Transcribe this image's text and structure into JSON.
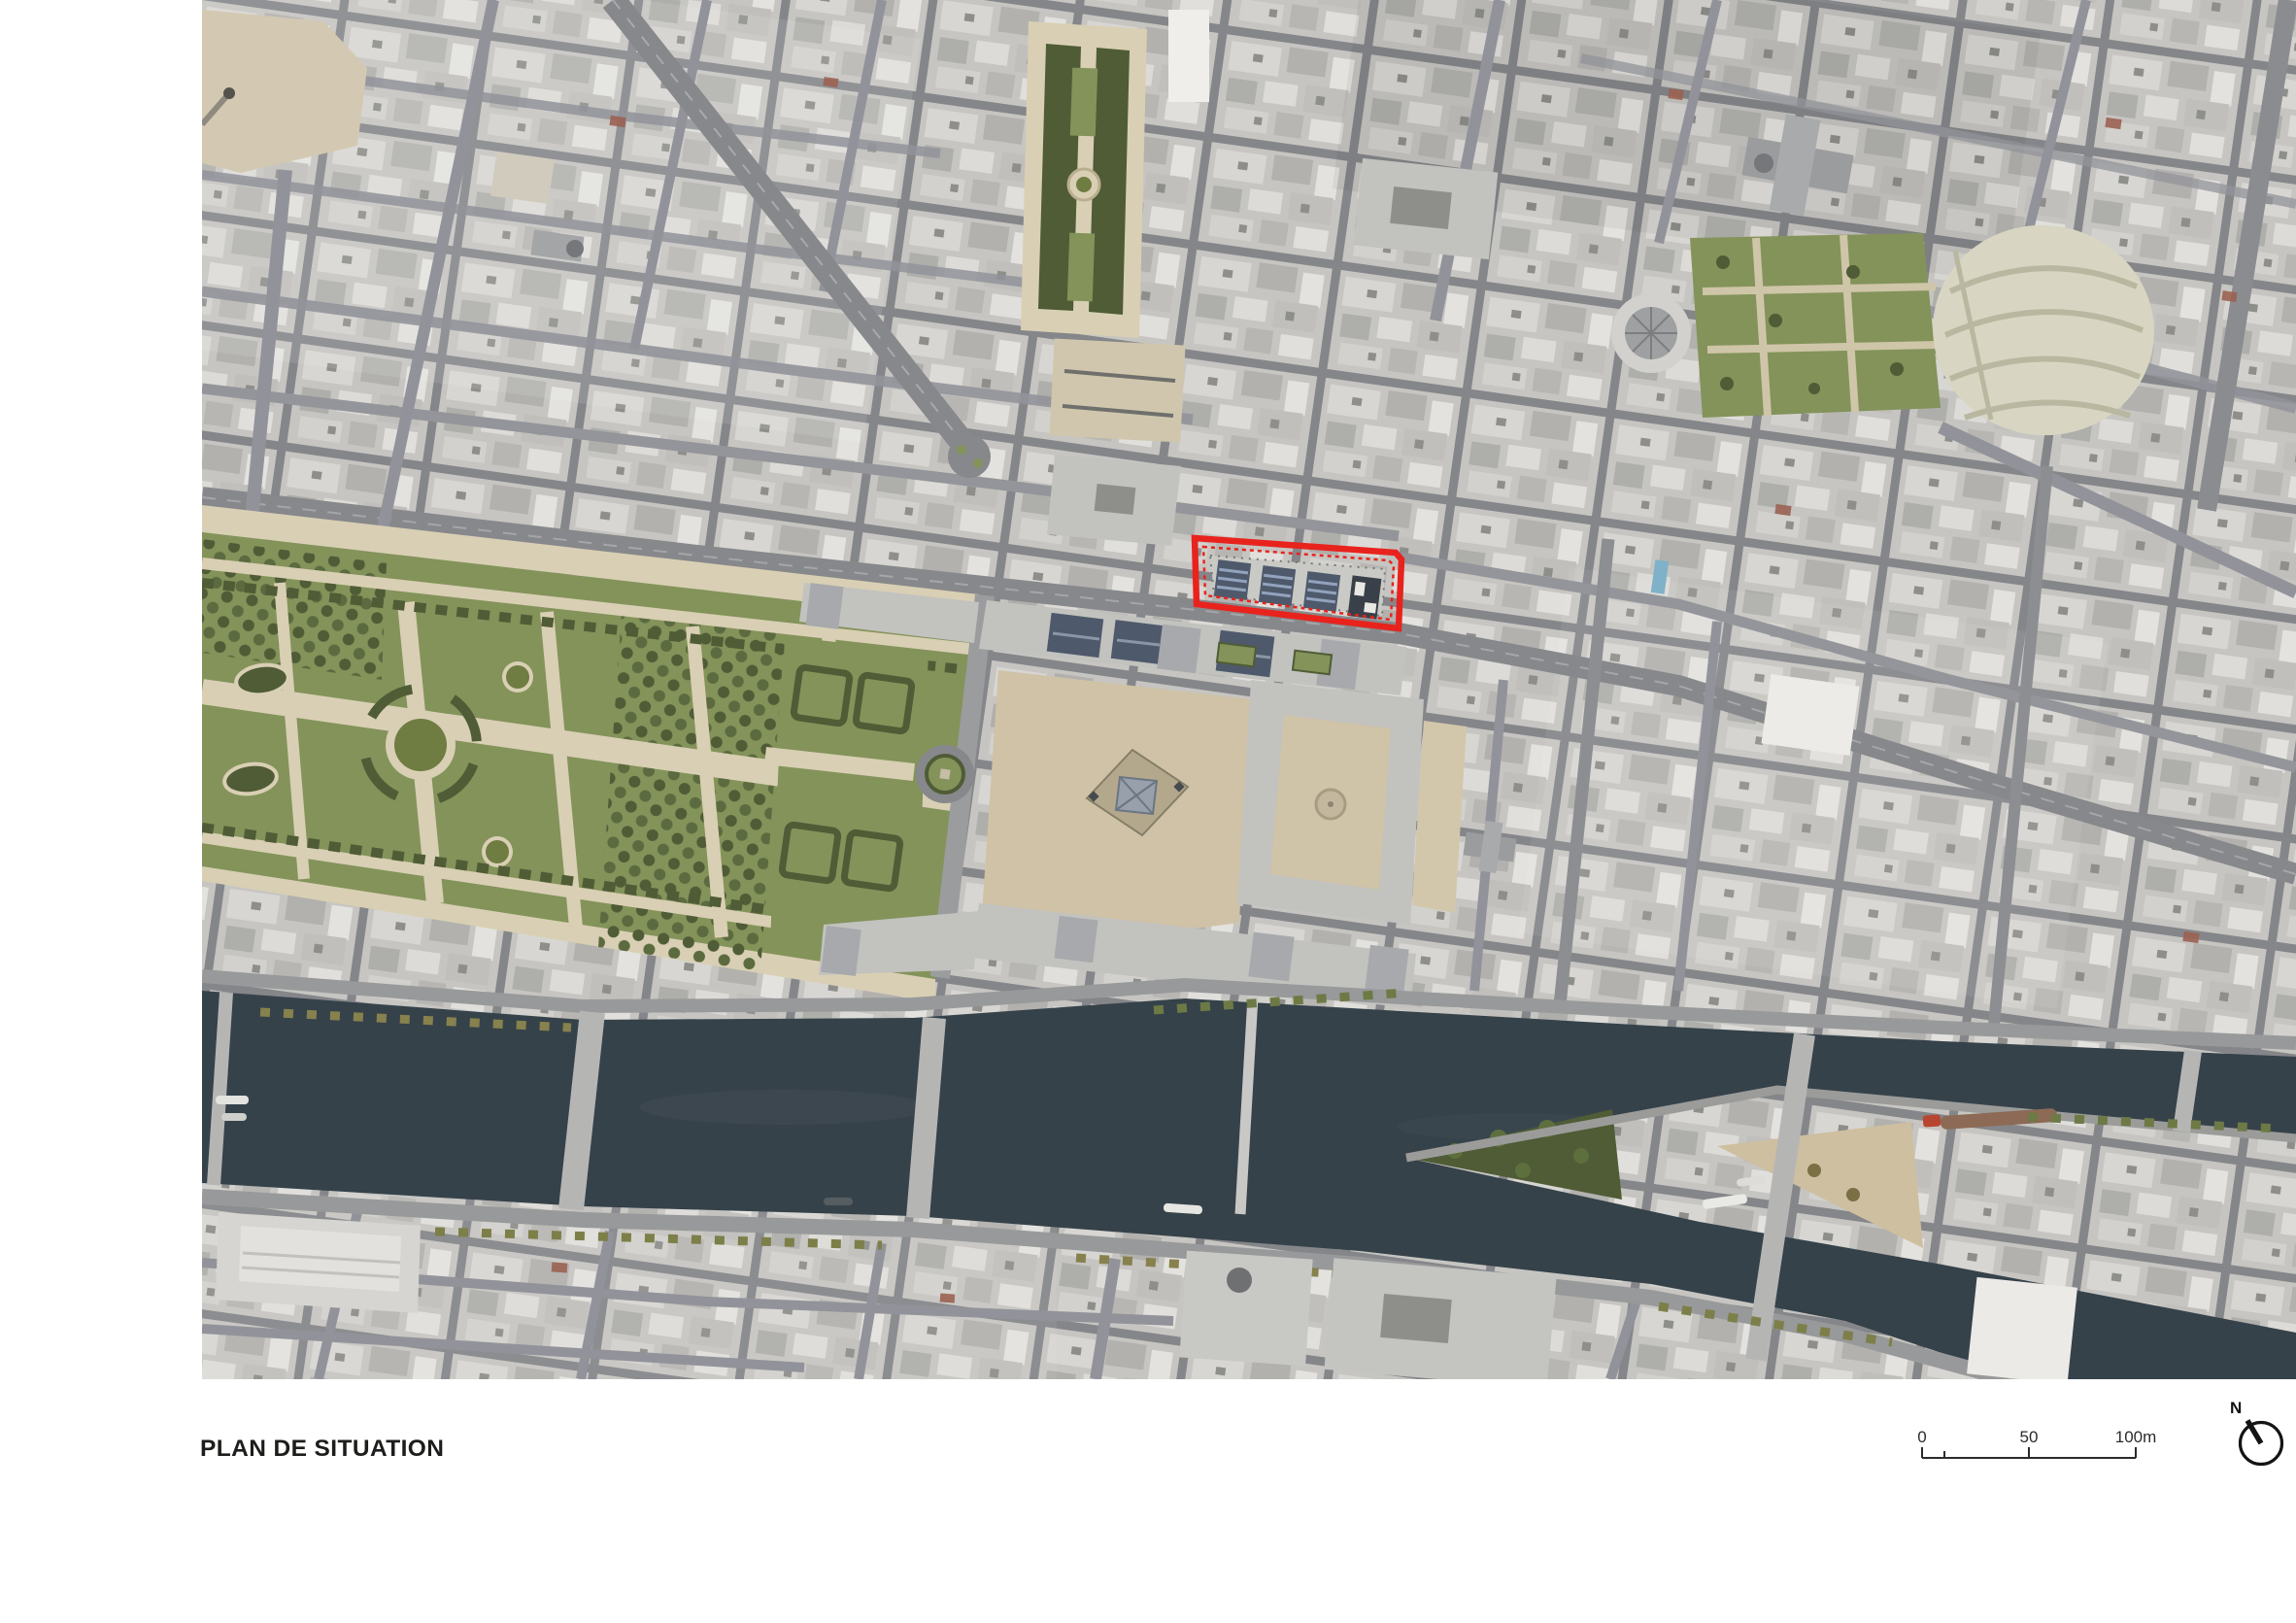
{
  "title": {
    "label": "PLAN DE SITUATION"
  },
  "map": {
    "kind": "aerial-orthophoto",
    "description": "Aerial view of central Paris around the Louvre: Tuileries Garden, Palais-Royal, Les Halles, the Seine with its bridges and the Ile de la Cite. A red outline marks the project site on the block between Rue Saint-Honore and Rue de Rivoli, north of the Louvre.",
    "colors": {
      "site_red": "#e8231d",
      "water": "#36424a",
      "lawn": "#83935a",
      "tree_dark": "#4f5c36",
      "path_beige": "#d9cfb4",
      "plaza_beige": "#cfc2a6",
      "roof_gray": "#c2c2bf",
      "street_gray": "#87888b",
      "glass_dark": "#4e5a6b"
    }
  },
  "scale_bar": {
    "labels": [
      "0",
      "50",
      "100m"
    ],
    "total_meters": 100
  },
  "compass": {
    "label": "N"
  }
}
